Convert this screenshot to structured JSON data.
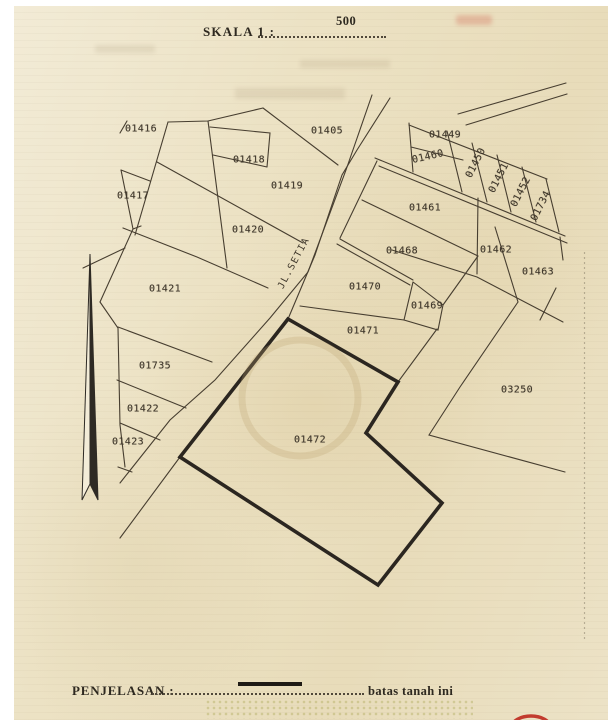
{
  "scale": {
    "label": "SKALA 1 :",
    "value": "500"
  },
  "legend": {
    "title": "PENJELASAN :",
    "note": "batas tanah ini"
  },
  "road": {
    "name": "JL.SETIA"
  },
  "parcels": [
    {
      "id": "01416",
      "x": 141,
      "y": 129,
      "rot": 0
    },
    {
      "id": "01417",
      "x": 133,
      "y": 196,
      "rot": 0
    },
    {
      "id": "01418",
      "x": 249,
      "y": 160,
      "rot": 0
    },
    {
      "id": "01419",
      "x": 287,
      "y": 186,
      "rot": 0
    },
    {
      "id": "01420",
      "x": 248,
      "y": 230,
      "rot": 0
    },
    {
      "id": "01405",
      "x": 327,
      "y": 131,
      "rot": 0
    },
    {
      "id": "01449",
      "x": 445,
      "y": 135,
      "rot": 0
    },
    {
      "id": "01460",
      "x": 428,
      "y": 157,
      "rot": -13
    },
    {
      "id": "01450",
      "x": 476,
      "y": 163,
      "rot": -63
    },
    {
      "id": "01451",
      "x": 499,
      "y": 178,
      "rot": -63
    },
    {
      "id": "01452",
      "x": 521,
      "y": 192,
      "rot": -63
    },
    {
      "id": "01734",
      "x": 541,
      "y": 206,
      "rot": -63
    },
    {
      "id": "01461",
      "x": 425,
      "y": 208,
      "rot": 0
    },
    {
      "id": "01462",
      "x": 496,
      "y": 250,
      "rot": 0
    },
    {
      "id": "01463",
      "x": 538,
      "y": 272,
      "rot": 0
    },
    {
      "id": "01468",
      "x": 402,
      "y": 251,
      "rot": 0
    },
    {
      "id": "01470",
      "x": 365,
      "y": 287,
      "rot": 0
    },
    {
      "id": "01469",
      "x": 427,
      "y": 306,
      "rot": 0
    },
    {
      "id": "01471",
      "x": 363,
      "y": 331,
      "rot": 0
    },
    {
      "id": "01421",
      "x": 165,
      "y": 289,
      "rot": 0
    },
    {
      "id": "01735",
      "x": 155,
      "y": 366,
      "rot": 0
    },
    {
      "id": "01422",
      "x": 143,
      "y": 409,
      "rot": 0
    },
    {
      "id": "01423",
      "x": 128,
      "y": 442,
      "rot": 0
    },
    {
      "id": "03250",
      "x": 517,
      "y": 390,
      "rot": 0
    },
    {
      "id": "01472",
      "x": 310,
      "y": 440,
      "rot": 0
    }
  ],
  "colors": {
    "paper": "#ece2c4",
    "ink": "#473e30",
    "boundary_highlight": "#2b2620",
    "stamp_red": "#c23b2e"
  }
}
